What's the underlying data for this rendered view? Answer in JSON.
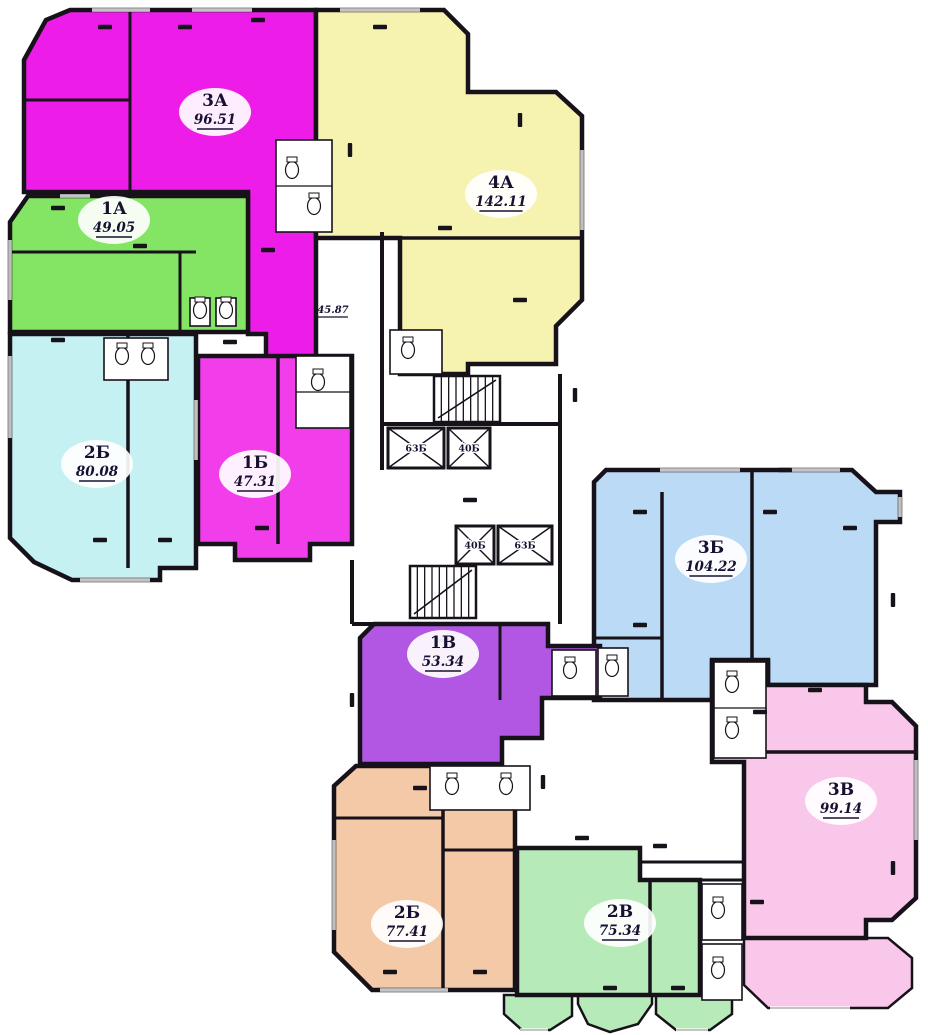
{
  "plan": {
    "type": "apartment-floor-plan",
    "colors": {
      "background": "#ffffff",
      "wall": "#17121a",
      "label_text": "#171031",
      "window": "#8a8a8a"
    },
    "apartments": [
      {
        "id": "3А",
        "area": "96.51",
        "color": "#ee1ce9"
      },
      {
        "id": "4А",
        "area": "142.11",
        "color": "#f6f3b1"
      },
      {
        "id": "1А",
        "area": "49.05",
        "color": "#83e563"
      },
      {
        "id": "2Б",
        "area": "80.08",
        "color": "#c5f1f3"
      },
      {
        "id": "1Б",
        "area": "47.31",
        "color": "#f23deb"
      },
      {
        "id": "3Б",
        "area": "104.22",
        "color": "#bbdaf6"
      },
      {
        "id": "1В",
        "area": "53.34",
        "color": "#b157e3"
      },
      {
        "id": "3В",
        "area": "99.14",
        "color": "#f8c7e9"
      },
      {
        "id": "2Б",
        "area": "77.41",
        "color": "#f3c9a7"
      },
      {
        "id": "2В",
        "area": "75.34",
        "color": "#b7eab9"
      }
    ],
    "elevators": [
      {
        "label": "63Б"
      },
      {
        "label": "40Б"
      },
      {
        "label": "40Б"
      },
      {
        "label": "63Б"
      }
    ],
    "hall_area_label": "45.87"
  }
}
